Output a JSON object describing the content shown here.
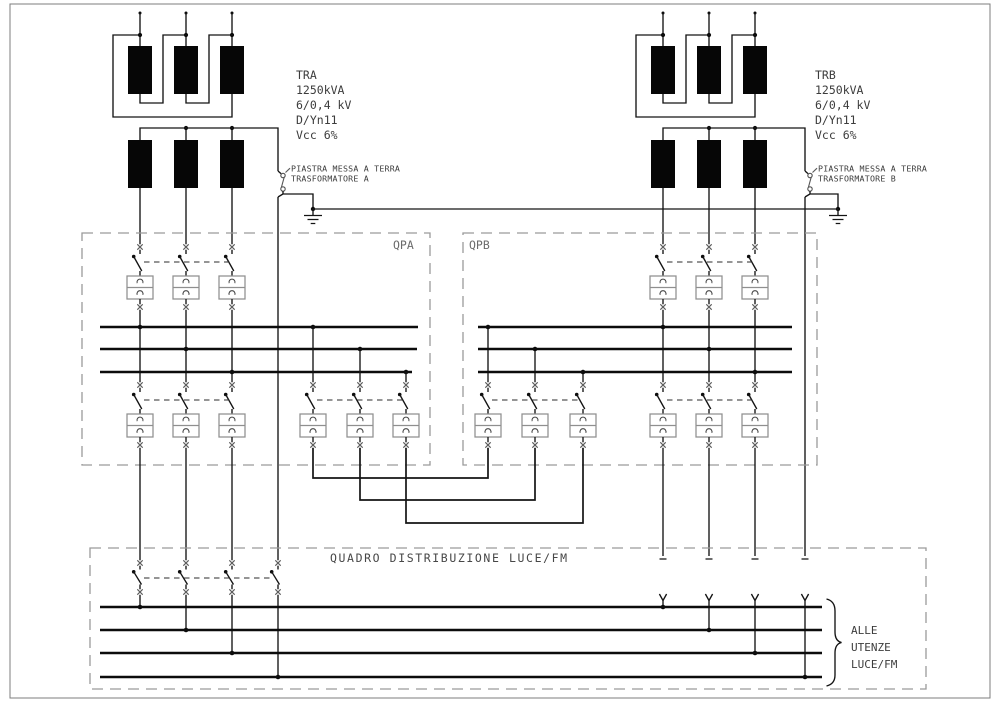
{
  "sheet": {
    "type": "electrical single line diagram",
    "colors": {
      "wire": "#141414",
      "dashed_box": "#9a9a9a",
      "text": "#3c3c3c",
      "relay_box": "#8f8f8f",
      "background": "#ffffff"
    }
  },
  "transformers": {
    "a": {
      "name": "TRA",
      "power": "1250kVA",
      "ratio": "6/0,4 kV",
      "vector_group": "D/Yn11",
      "impedance": "Vcc 6%",
      "earth_plate_line1": "PIASTRA MESSA A TERRA",
      "earth_plate_line2": "TRASFORMATORE A"
    },
    "b": {
      "name": "TRB",
      "power": "1250kVA",
      "ratio": "6/0,4 kV",
      "vector_group": "D/Yn11",
      "impedance": "Vcc 6%",
      "earth_plate_line1": "PIASTRA MESSA A TERRA",
      "earth_plate_line2": "TRASFORMATORE B"
    }
  },
  "switchboards": {
    "qpa_label": "QPA",
    "qpb_label": "QPB",
    "distribution_label": "QUADRO DISTRIBUZIONE LUCE/FM"
  },
  "outgoing": {
    "line1": "ALLE",
    "line2": "UTENZE",
    "line3": "LUCE/FM"
  }
}
